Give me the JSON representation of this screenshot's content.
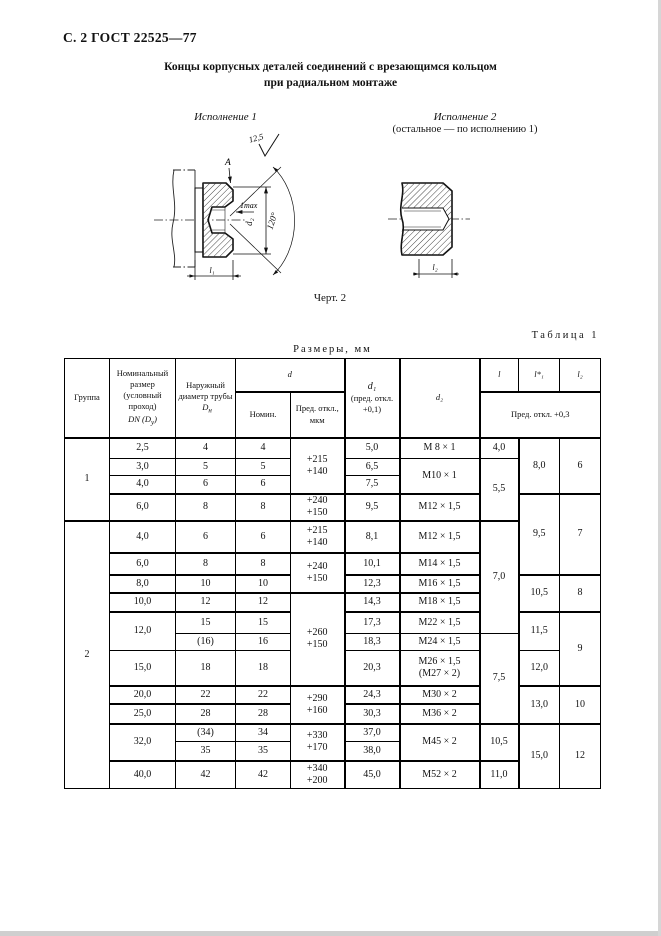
{
  "page_header": "С. 2 ГОСТ 22525—77",
  "title": {
    "line1": "Концы корпусных деталей соединений с врезающимся кольцом",
    "line2": "при радиальном монтаже"
  },
  "figure": {
    "variant1": "Исполнение 1",
    "variant2": "Исполнение 2",
    "variant2_note": "(остальное — по исполнению 1)",
    "caption": "Черт. 2",
    "labels": {
      "roughness": "12,5",
      "view": "А",
      "one_max": "1max",
      "d2": "d₂",
      "angle": "120°",
      "l1": "l₁",
      "l2": "l₂"
    }
  },
  "table": {
    "caption": "Таблица 1",
    "units": "Размеры, мм",
    "head": {
      "group": "Группа",
      "nominal_text": "Номинальный размер (условный проход)",
      "nominal_sym": "DN (D",
      "nominal_sub": "у",
      "nominal_close": ")",
      "outer_text": "Наружный диаметр трубы",
      "outer_sym": "D",
      "outer_sub": "н",
      "d": "d",
      "d_nom": "Номин.",
      "d_dev": "Пред. откл., мкм",
      "d1_sym": "d₁",
      "d1_note": "(пред. откл. +0,1)",
      "d2": "d₂",
      "l": "l",
      "l1": "l*₁",
      "l2": "l₂",
      "l_dev": "Пред. откл. +0,3"
    },
    "rows": [
      {
        "group": "1",
        "nom": "2,5",
        "out": "4",
        "dn": "4",
        "dd": "+215\n+140",
        "d1": "5,0",
        "d2": "М 8 × 1",
        "l": "4,0",
        "l1": "8,0",
        "l2": "6"
      },
      {
        "nom": "3,0",
        "out": "5",
        "dn": "5",
        "d1": "6,5",
        "d2": "М10 × 1",
        "l": "5,5"
      },
      {
        "nom": "4,0",
        "out": "6",
        "dn": "6",
        "d1": "7,5"
      },
      {
        "nom": "6,0",
        "out": "8",
        "dn": "8",
        "dd": "+240\n+150",
        "d1": "9,5",
        "d2": "М12 × 1,5",
        "l1": "9,5",
        "l2": "7"
      },
      {
        "group": "2",
        "nom": "4,0",
        "out": "6",
        "dn": "6",
        "dd": "+215\n+140",
        "d1": "8,1",
        "d2": "М12 × 1,5",
        "l": "7,0"
      },
      {
        "nom": "6,0",
        "out": "8",
        "dn": "8",
        "dd": "+240\n+150",
        "d1": "10,1",
        "d2": "М14 × 1,5"
      },
      {
        "nom": "8,0",
        "out": "10",
        "dn": "10",
        "d1": "12,3",
        "d2": "М16 × 1,5",
        "l1": "10,5",
        "l2": "8"
      },
      {
        "nom": "10,0",
        "out": "12",
        "dn": "12",
        "dd": "+260\n+150",
        "d1": "14,3",
        "d2": "М18 × 1,5"
      },
      {
        "nom": "12,0",
        "out": "15",
        "dn": "15",
        "d1": "17,3",
        "d2": "М22 × 1,5",
        "l1": "11,5",
        "l2": "9"
      },
      {
        "out": "(16)",
        "dn": "16",
        "d1": "18,3",
        "d2": "М24 × 1,5",
        "l": "7,5"
      },
      {
        "nom": "15,0",
        "out": "18",
        "dn": "18",
        "d1": "20,3",
        "d2": "М26 × 1,5\n(М27 × 2)",
        "l1": "12,0"
      },
      {
        "nom": "20,0",
        "out": "22",
        "dn": "22",
        "dd": "+290\n+160",
        "d1": "24,3",
        "d2": "М30 × 2",
        "l1": "13,0",
        "l2": "10"
      },
      {
        "nom": "25,0",
        "out": "28",
        "dn": "28",
        "d1": "30,3",
        "d2": "М36 × 2"
      },
      {
        "nom": "32,0",
        "out": "(34)",
        "dn": "34",
        "dd": "+330\n+170",
        "d1": "37,0",
        "d2": "М45 × 2",
        "l": "10,5",
        "l1": "15,0",
        "l2": "12"
      },
      {
        "out": "35",
        "dn": "35",
        "d1": "38,0"
      },
      {
        "nom": "40,0",
        "out": "42",
        "dn": "42",
        "dd": "+340\n+200",
        "d1": "45,0",
        "d2": "М52 × 2",
        "l": "11,0"
      }
    ]
  }
}
